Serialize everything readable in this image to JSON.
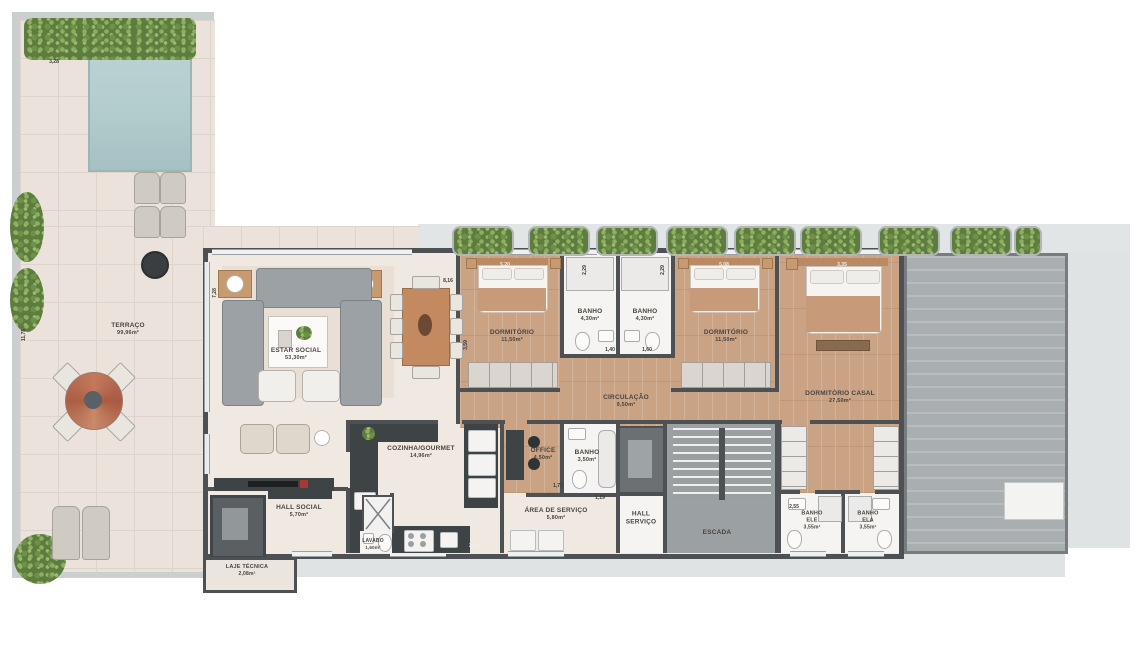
{
  "rooms": {
    "terraco": {
      "l1": "TERRAÇO",
      "l2": "99,96m²"
    },
    "estar": {
      "l1": "ESTAR SOCIAL",
      "l2": "53,30m²"
    },
    "dorm1": {
      "l1": "DORMITÓRIO",
      "l2": "11,50m²"
    },
    "banho1": {
      "l1": "BANHO",
      "l2": "4,30m²"
    },
    "banho2": {
      "l1": "BANHO",
      "l2": "4,30m²"
    },
    "dorm2": {
      "l1": "DORMITÓRIO",
      "l2": "11,50m²"
    },
    "casal": {
      "l1": "DORMITÓRIO CASAL",
      "l2": "27,50m²"
    },
    "circulacao": {
      "l1": "CIRCULAÇÃO",
      "l2": "9,50m²"
    },
    "cozinha": {
      "l1": "COZINHA/GOURMET",
      "l2": "14,96m²"
    },
    "office": {
      "l1": "OFFICE",
      "l2": "4,50m²"
    },
    "banho3": {
      "l1": "BANHO",
      "l2": "3,50m²"
    },
    "areaservico": {
      "l1": "ÁREA DE SERVIÇO",
      "l2": "5,80m²"
    },
    "hallservico": {
      "l1": "HALL",
      "l2": "SERVIÇO"
    },
    "escada": {
      "l1": "ESCADA"
    },
    "hallsocial": {
      "l1": "HALL SOCIAL",
      "l2": "5,70m²"
    },
    "lavabo": {
      "l1": "LAVABO",
      "l2": "1,60m²"
    },
    "laje": {
      "l1": "LAJE TÉCNICA",
      "l2": "2,08m²"
    },
    "banhoele": {
      "l1": "BANHO",
      "l2": "ELE",
      "l3": "3,55m²"
    },
    "banhoela": {
      "l1": "BANHO",
      "l2": "ELA",
      "l3": "3,55m²"
    }
  },
  "dimensions": {
    "pool_width": "3,28",
    "terrace_height": "11,75",
    "estar_height": "7,28",
    "dining_width": "8,16",
    "dorm1_width": "5,20",
    "banho1_width": "2,29",
    "banho2_width": "2,29",
    "dorm2_width": "5,08",
    "casal_width": "3,35",
    "dorm1_height": "3,59",
    "banho1_depth": "1,40",
    "banho2_depth": "1,60",
    "office_depth": "1,77",
    "kitchen_width": "2,60",
    "banhoele_width": "2,55",
    "servico_dim": "1,19"
  },
  "colors": {
    "wall": "#4d5154",
    "wood_floor": "#c9a384",
    "interior_floor": "#f0e9e2",
    "terrace_floor": "#eae2db",
    "pool_water": "#b3cccd",
    "vegetation": "#6f9048",
    "roof_deck": "#a9aeb0",
    "surround": "#e2e5e6",
    "counter": "#3e4345"
  }
}
